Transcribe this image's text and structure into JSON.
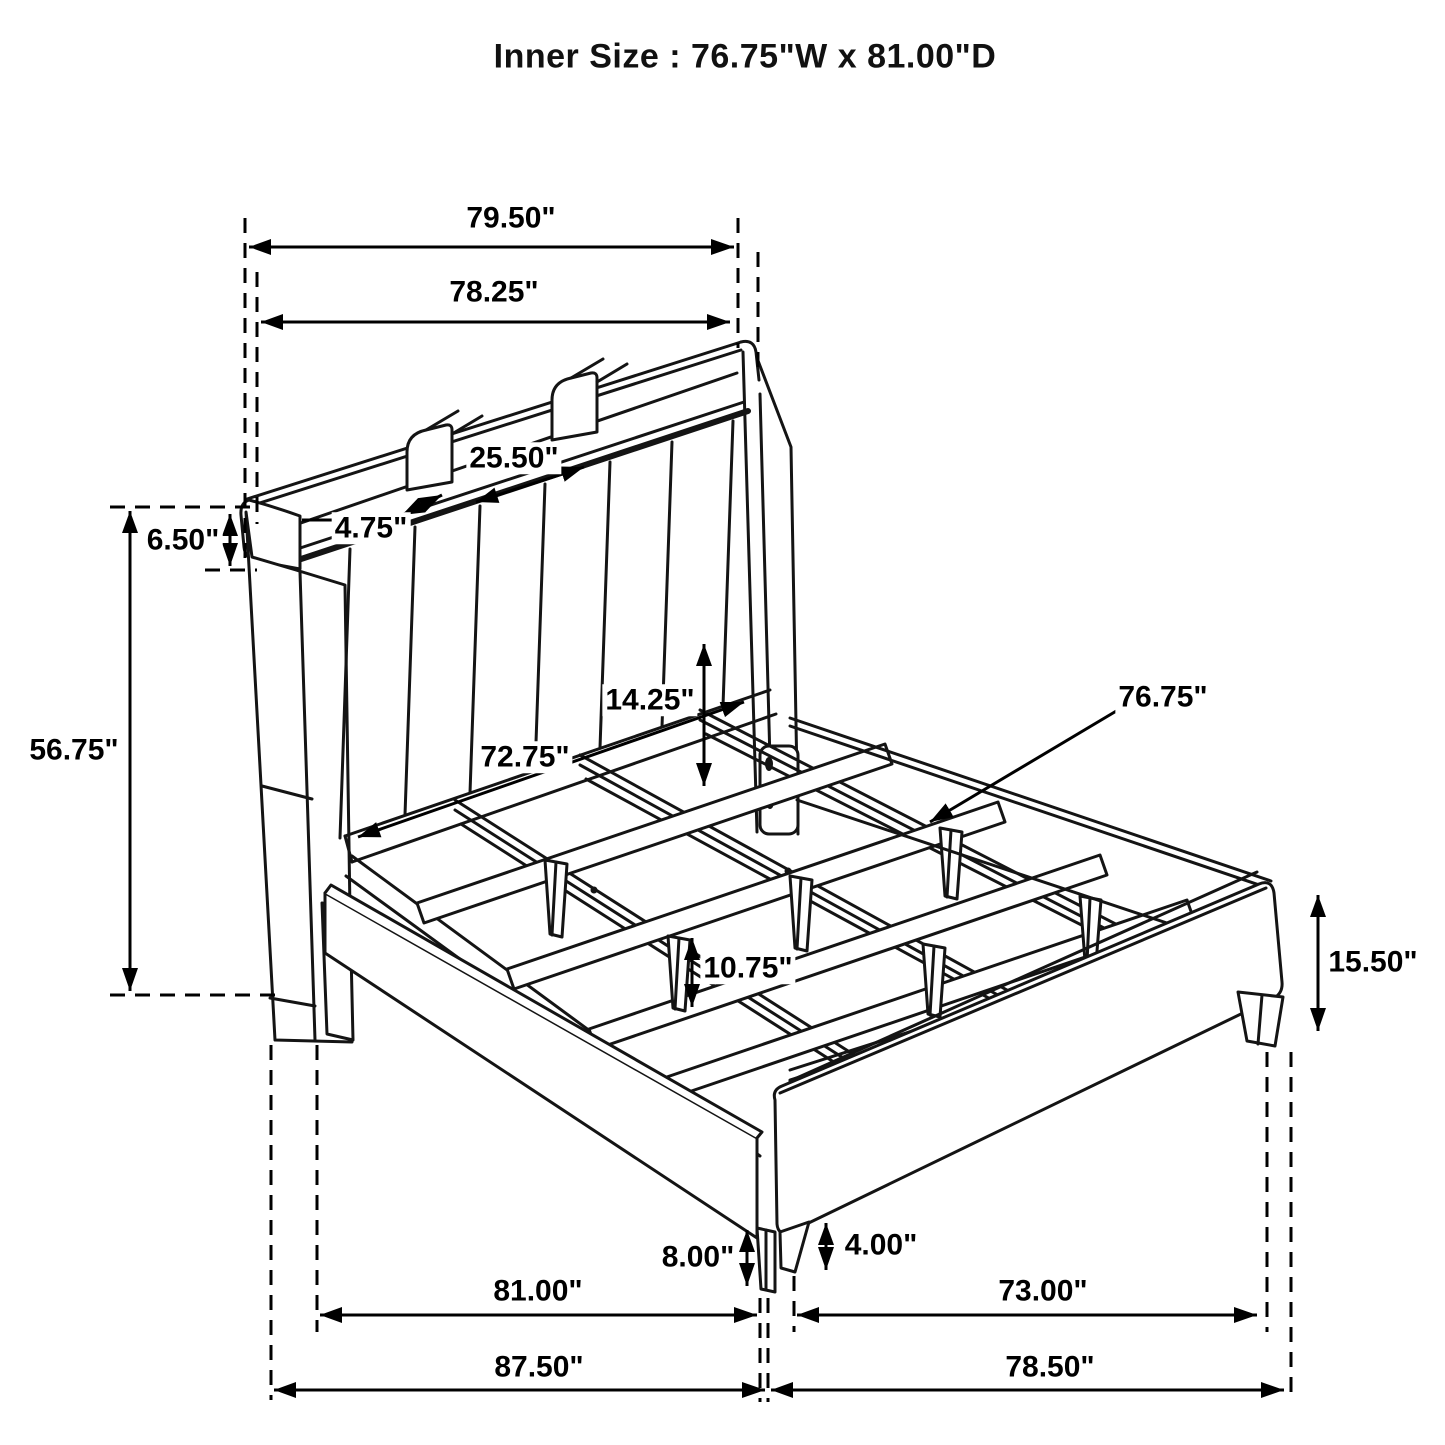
{
  "title": "Inner Size : 76.75\"W x 81.00\"D",
  "drawing": {
    "subject": "bed with bookcase headboard - technical dimension line drawing",
    "units": "inches",
    "line_color": "#111111",
    "background": "#ffffff"
  },
  "dimensions": {
    "top_width_outer": "79.50\"",
    "top_width_inner": "78.25\"",
    "shelf_opening_width": "25.50\"",
    "shelf_depth": "4.75\"",
    "shelf_height": "6.50\"",
    "headboard_height": "56.75\"",
    "rail_to_slat_height": "14.25\"",
    "inner_rail_width": "72.75\"",
    "slat_rail_length": "76.75\"",
    "support_leg_height": "10.75\"",
    "footboard_height": "15.50\"",
    "front_leg_height": "8.00\"",
    "footboard_leg_height": "4.00\"",
    "base_inner_depth": "81.00\"",
    "footboard_inner_width": "73.00\"",
    "overall_depth": "87.50\"",
    "overall_width": "78.50\""
  }
}
